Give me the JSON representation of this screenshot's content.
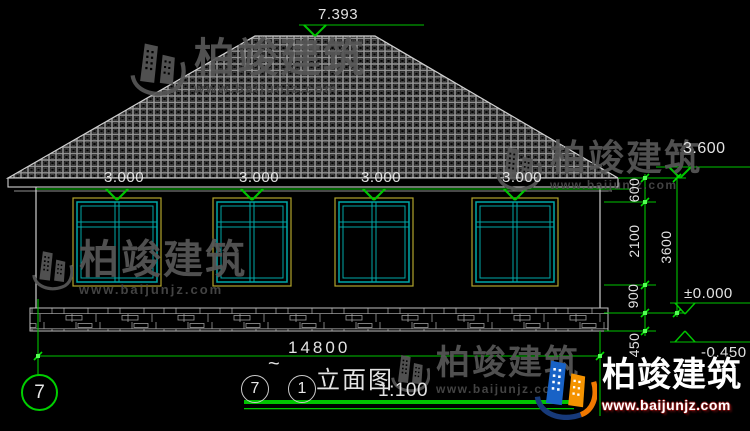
{
  "drawing_title": {
    "axis_from": "7",
    "tilde": "~",
    "axis_to": "1",
    "name": "立面图",
    "scale": "1:100"
  },
  "axis": {
    "left_bubble": "7"
  },
  "levels": {
    "ridge": "7.393",
    "eave": "3.000",
    "right_eave": "3.600",
    "zero": "±0.000",
    "below_grade": "-0.450"
  },
  "dims": {
    "total_width": "14800",
    "d600": "600",
    "d2100": "2100",
    "d900": "900",
    "d450": "450",
    "d3600": "3600"
  },
  "watermark": {
    "brand": "柏竣建筑",
    "url": "www.baijunjz.com"
  },
  "logo": {
    "brand": "柏竣建筑",
    "url": "www.baijunjz.com"
  },
  "colors": {
    "background": "#000000",
    "cad_line": "#cfcfcf",
    "dimension_green": "#00c400",
    "window_frame_yellow": "#b0a42c",
    "window_sash_cyan": "#00a8a8",
    "watermark_gray": "#575757",
    "logo_blue": "#1862c6",
    "logo_orange": "#f59300"
  }
}
